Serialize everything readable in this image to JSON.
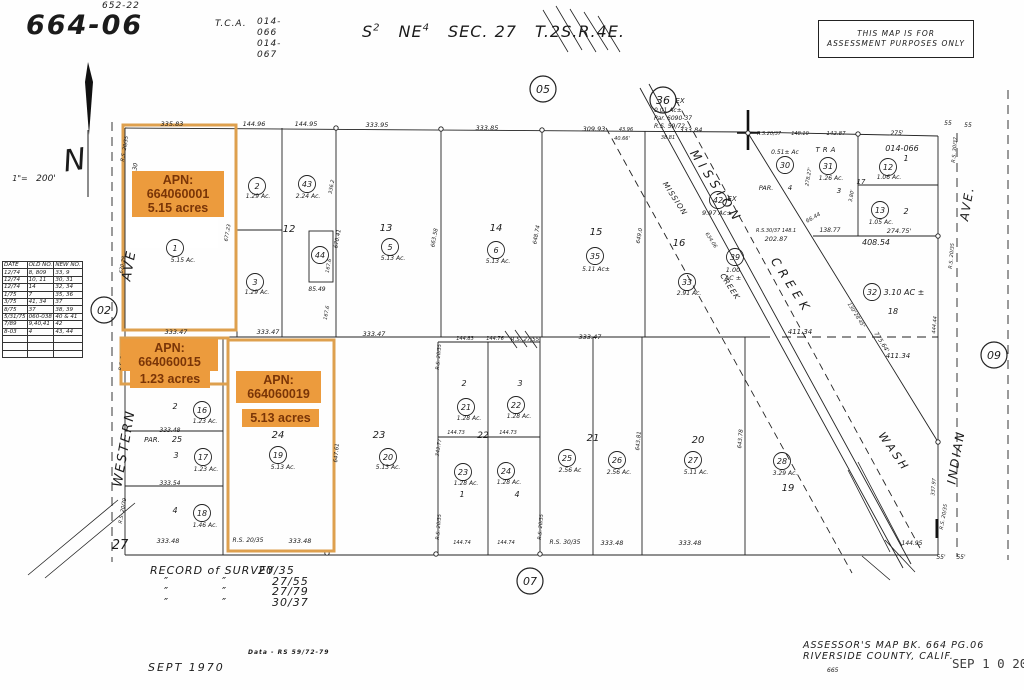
{
  "header": {
    "map_number": "664-06",
    "map_number_sup": "652-22",
    "tca_label": "T.C.A.",
    "tca_value1": "014-066",
    "tca_value2": "014-067",
    "section": {
      "s1": "S",
      "s1sup": "2",
      "s2": "NE",
      "s2sup": "4",
      "s3": "SEC. 27",
      "s4": "T.2S.R.4E."
    }
  },
  "disclaimer": {
    "line1": "THIS MAP IS FOR",
    "line2": "ASSESSMENT PURPOSES ONLY"
  },
  "legend_table": {
    "headers": [
      "DATE",
      "OLD NO.",
      "NEW NO."
    ],
    "rows": [
      [
        "12/74",
        "8, 809",
        "33, 9"
      ],
      [
        "12/74",
        "10, 11",
        "30, 31"
      ],
      [
        "12/74",
        "14",
        "32, 34"
      ],
      [
        "1/75",
        "7",
        "35, 36"
      ],
      [
        "3/75",
        "41, 34",
        "37"
      ],
      [
        "8/75",
        "37",
        "38, 39"
      ],
      [
        "5/31/75",
        "060-038",
        "40 & 41"
      ],
      [
        "7/89",
        "9,40,41",
        "42"
      ],
      [
        "8-03",
        "4",
        "43, 44"
      ]
    ],
    "empty_rows": 3
  },
  "badges": {
    "apn1": {
      "l1": "APN:",
      "l2": "664060001",
      "l3": "5.15 acres"
    },
    "apn2": {
      "l1": "APN:",
      "l2": "664060015",
      "l3": "1.23 acres"
    },
    "apn3": {
      "l1": "APN:",
      "l2": "664060019",
      "l3": "5.13 acres"
    }
  },
  "footer": {
    "survey_title": "RECORD of SURVEY",
    "survey_pages": [
      "20/35",
      "27/55",
      "27/79",
      "30/37"
    ],
    "ditto_mark": "″",
    "data_note": "Data - RS 59/72-79",
    "map_date": "SEPT 1970",
    "assessor_line1": "ASSESSOR'S MAP BK. 664  PG.06",
    "assessor_line2": "RIVERSIDE COUNTY, CALIF.",
    "plate_number": "665",
    "stamp": "SEP 1 0 2003"
  },
  "map": {
    "ref_circles": [
      {
        "n": "05",
        "x": 543,
        "y": 89
      },
      {
        "n": "02",
        "x": 104,
        "y": 310
      },
      {
        "n": "07",
        "x": 530,
        "y": 581
      },
      {
        "n": "09",
        "x": 994,
        "y": 355
      },
      {
        "n": "36",
        "x": 663,
        "y": 100
      }
    ],
    "parcel_circles": [
      {
        "n": "1",
        "x": 175,
        "y": 248
      },
      {
        "n": "2",
        "x": 257,
        "y": 186
      },
      {
        "n": "3",
        "x": 255,
        "y": 282
      },
      {
        "n": "43",
        "x": 307,
        "y": 184
      },
      {
        "n": "44",
        "x": 320,
        "y": 255
      },
      {
        "n": "5",
        "x": 390,
        "y": 247
      },
      {
        "n": "6",
        "x": 496,
        "y": 250
      },
      {
        "n": "35",
        "x": 595,
        "y": 256
      },
      {
        "n": "42",
        "x": 718,
        "y": 200
      },
      {
        "n": "33",
        "x": 687,
        "y": 282
      },
      {
        "n": "39",
        "x": 735,
        "y": 257
      },
      {
        "n": "30",
        "x": 785,
        "y": 165
      },
      {
        "n": "31",
        "x": 828,
        "y": 166
      },
      {
        "n": "12",
        "x": 888,
        "y": 167
      },
      {
        "n": "13",
        "x": 880,
        "y": 210
      },
      {
        "n": "32",
        "x": 872,
        "y": 292
      },
      {
        "n": "16",
        "x": 202,
        "y": 410
      },
      {
        "n": "17",
        "x": 203,
        "y": 457
      },
      {
        "n": "18",
        "x": 202,
        "y": 513
      },
      {
        "n": "19",
        "x": 278,
        "y": 455
      },
      {
        "n": "20",
        "x": 388,
        "y": 457
      },
      {
        "n": "21",
        "x": 466,
        "y": 407
      },
      {
        "n": "22",
        "x": 516,
        "y": 405
      },
      {
        "n": "23",
        "x": 463,
        "y": 472
      },
      {
        "n": "24",
        "x": 506,
        "y": 471
      },
      {
        "n": "25",
        "x": 567,
        "y": 458
      },
      {
        "n": "26",
        "x": 617,
        "y": 460
      },
      {
        "n": "27",
        "x": 693,
        "y": 460
      },
      {
        "n": "28",
        "x": 782,
        "y": 461
      }
    ],
    "texts": [
      {
        "t": "N",
        "x": 76,
        "y": 170,
        "s": 30,
        "r": -8
      },
      {
        "t": "1\"=",
        "x": 20,
        "y": 181,
        "s": 8
      },
      {
        "t": "200'",
        "x": 46,
        "y": 181,
        "s": 9
      },
      {
        "t": "335.83",
        "x": 172,
        "y": 126
      },
      {
        "t": "144.96",
        "x": 254,
        "y": 126
      },
      {
        "t": "144.95",
        "x": 306,
        "y": 126
      },
      {
        "t": "333.95",
        "x": 377,
        "y": 127
      },
      {
        "t": "333.85",
        "x": 487,
        "y": 130
      },
      {
        "t": "309.93",
        "x": 594,
        "y": 131
      },
      {
        "t": "43.96",
        "x": 626,
        "y": 131,
        "s": 5
      },
      {
        "t": "40.66'",
        "x": 622,
        "y": 140,
        "s": 5
      },
      {
        "t": "38.81",
        "x": 668,
        "y": 139,
        "s": 5
      },
      {
        "t": "333.84",
        "x": 691,
        "y": 132
      },
      {
        "t": "R.S.20/37",
        "x": 769,
        "y": 135,
        "s": 5
      },
      {
        "t": "148.10",
        "x": 800,
        "y": 135,
        "s": 5
      },
      {
        "t": "142.87",
        "x": 836,
        "y": 135,
        "s": 5.5
      },
      {
        "t": "275'",
        "x": 897,
        "y": 135,
        "s": 6
      },
      {
        "t": "55",
        "x": 948,
        "y": 125,
        "s": 6
      },
      {
        "t": "55",
        "x": 968,
        "y": 127,
        "s": 6
      },
      {
        "t": "EX",
        "x": 680,
        "y": 103,
        "s": 7
      },
      {
        "t": "0.01 Ac±",
        "x": 654,
        "y": 112,
        "s": 6,
        "a": "s"
      },
      {
        "t": "Par. 6090-37",
        "x": 654,
        "y": 120,
        "s": 6,
        "a": "s"
      },
      {
        "t": "R.S. 59/72",
        "x": 654,
        "y": 128,
        "s": 6,
        "a": "s"
      },
      {
        "t": "TRA",
        "x": 827,
        "y": 152,
        "s": 7,
        "ls": 3
      },
      {
        "t": "014-066",
        "x": 902,
        "y": 151,
        "s": 8
      },
      {
        "t": "1",
        "x": 906,
        "y": 161,
        "s": 8
      },
      {
        "t": "1.06 Ac.",
        "x": 889,
        "y": 179,
        "s": 6
      },
      {
        "t": "2",
        "x": 906,
        "y": 214,
        "s": 8
      },
      {
        "t": "1.05 Ac.",
        "x": 881,
        "y": 224,
        "s": 6
      },
      {
        "t": "17",
        "x": 861,
        "y": 184,
        "s": 7
      },
      {
        "t": "274.75'",
        "x": 899,
        "y": 233,
        "s": 6.5
      },
      {
        "t": "408.54",
        "x": 876,
        "y": 245,
        "s": 8
      },
      {
        "t": "0.51± Ac",
        "x": 785,
        "y": 154,
        "s": 6
      },
      {
        "t": "PAR.",
        "x": 766,
        "y": 190,
        "s": 6.5
      },
      {
        "t": "4",
        "x": 790,
        "y": 190,
        "s": 7
      },
      {
        "t": "1.26 Ac.",
        "x": 831,
        "y": 180,
        "s": 6
      },
      {
        "t": "3",
        "x": 839,
        "y": 193,
        "s": 7
      },
      {
        "t": "278.27'",
        "x": 810,
        "y": 177,
        "s": 5,
        "r": -80
      },
      {
        "t": "3.80'",
        "x": 853,
        "y": 196,
        "s": 5,
        "r": -80
      },
      {
        "t": "R.S.30/37 148.1",
        "x": 756,
        "y": 232,
        "s": 5,
        "a": "s"
      },
      {
        "t": "202.87",
        "x": 776,
        "y": 241,
        "s": 6.5
      },
      {
        "t": "66.44",
        "x": 814,
        "y": 219,
        "s": 5.5,
        "r": -30
      },
      {
        "t": "138.77",
        "x": 830,
        "y": 232,
        "s": 6
      },
      {
        "t": "R.S. 30/37",
        "x": 956,
        "y": 150,
        "s": 5,
        "r": -85
      },
      {
        "t": "411.34",
        "x": 800,
        "y": 334,
        "s": 7
      },
      {
        "t": "411.34",
        "x": 898,
        "y": 358,
        "s": 7
      },
      {
        "t": "3.10 AC ±",
        "x": 904,
        "y": 295,
        "s": 8
      },
      {
        "t": "18",
        "x": 893,
        "y": 314,
        "s": 8
      },
      {
        "t": "130°28'45\"",
        "x": 855,
        "y": 316,
        "s": 5,
        "r": 58
      },
      {
        "t": "775.64'",
        "x": 880,
        "y": 343,
        "s": 6,
        "r": 58
      },
      {
        "t": "444.44",
        "x": 936,
        "y": 325,
        "s": 5,
        "r": -85
      },
      {
        "t": "R.S. 20/35",
        "x": 953,
        "y": 256,
        "s": 5,
        "r": -85
      },
      {
        "t": "337.97",
        "x": 935,
        "y": 487,
        "s": 5,
        "r": -85
      },
      {
        "t": "R.S. 20/35",
        "x": 945,
        "y": 517,
        "s": 5,
        "r": -80
      },
      {
        "t": "144.95",
        "x": 912,
        "y": 545,
        "s": 6
      },
      {
        "t": "55'",
        "x": 941,
        "y": 559,
        "s": 6
      },
      {
        "t": "55'",
        "x": 961,
        "y": 559,
        "s": 6
      },
      {
        "t": "AVE",
        "x": 133,
        "y": 266,
        "s": 13,
        "r": -80,
        "ls": 2
      },
      {
        "t": "WESTERN",
        "x": 128,
        "y": 449,
        "s": 13,
        "r": -80,
        "ls": 2
      },
      {
        "t": "MISSION",
        "x": 713,
        "y": 189,
        "s": 12,
        "r": 57,
        "ls": 5
      },
      {
        "t": "CREEK",
        "x": 788,
        "y": 288,
        "s": 12,
        "r": 57,
        "ls": 5
      },
      {
        "t": "MISSION",
        "x": 673,
        "y": 200,
        "s": 7.5,
        "r": 57,
        "ls": 1
      },
      {
        "t": "CREEK",
        "x": 728,
        "y": 288,
        "s": 7.5,
        "r": 57,
        "ls": 1
      },
      {
        "t": "634.06",
        "x": 710,
        "y": 241,
        "s": 5,
        "r": 57
      },
      {
        "t": "WASH",
        "x": 891,
        "y": 454,
        "s": 11,
        "r": 55,
        "ls": 3
      },
      {
        "t": "INDIAN",
        "x": 960,
        "y": 458,
        "s": 12,
        "r": -80,
        "ls": 2
      },
      {
        "t": "AVE.",
        "x": 971,
        "y": 204,
        "s": 12,
        "r": -80,
        "ls": 2
      },
      {
        "t": "12",
        "x": 289,
        "y": 232,
        "s": 10
      },
      {
        "t": "13",
        "x": 386,
        "y": 231,
        "s": 10
      },
      {
        "t": "14",
        "x": 496,
        "y": 231,
        "s": 10
      },
      {
        "t": "15",
        "x": 596,
        "y": 235,
        "s": 10
      },
      {
        "t": "16",
        "x": 679,
        "y": 246,
        "s": 10
      },
      {
        "t": "5.15 Ac.",
        "x": 183,
        "y": 262,
        "s": 6
      },
      {
        "t": "1.29 Ac.",
        "x": 258,
        "y": 198,
        "s": 6
      },
      {
        "t": "1.29 Ac.",
        "x": 257,
        "y": 294,
        "s": 6
      },
      {
        "t": "2.24 Ac.",
        "x": 308,
        "y": 198,
        "s": 6
      },
      {
        "t": "5.13 Ac.",
        "x": 393,
        "y": 260,
        "s": 6
      },
      {
        "t": "5.13 Ac.",
        "x": 498,
        "y": 263,
        "s": 6
      },
      {
        "t": "5.11 Ac±",
        "x": 596,
        "y": 271,
        "s": 6
      },
      {
        "t": "2.91 Ac.",
        "x": 689,
        "y": 295,
        "s": 6
      },
      {
        "t": "9.97 Ac±",
        "x": 717,
        "y": 215,
        "s": 6.5
      },
      {
        "t": "EX",
        "x": 732,
        "y": 201,
        "s": 7
      },
      {
        "t": "1.00",
        "x": 733,
        "y": 272,
        "s": 6.5
      },
      {
        "t": "AC ±",
        "x": 733,
        "y": 280,
        "s": 6.5
      },
      {
        "t": "85.49",
        "x": 317,
        "y": 291,
        "s": 6
      },
      {
        "t": "167.6",
        "x": 330,
        "y": 266,
        "s": 5,
        "r": -80
      },
      {
        "t": "167.6",
        "x": 328,
        "y": 313,
        "s": 5,
        "r": -80
      },
      {
        "t": "336.2",
        "x": 333,
        "y": 187,
        "s": 5,
        "r": -80
      },
      {
        "t": "670.41",
        "x": 339,
        "y": 239,
        "s": 5.5,
        "r": -80
      },
      {
        "t": "663.58",
        "x": 436,
        "y": 238,
        "s": 5.5,
        "r": -80
      },
      {
        "t": "648.74",
        "x": 538,
        "y": 235,
        "s": 5.5,
        "r": -80
      },
      {
        "t": "649.0",
        "x": 641,
        "y": 236,
        "s": 5.5,
        "r": -80
      },
      {
        "t": "677.23",
        "x": 229,
        "y": 233,
        "s": 5,
        "r": -80
      },
      {
        "t": "670.28",
        "x": 124,
        "y": 265,
        "s": 5,
        "r": -80
      },
      {
        "t": "R.S. 20/35",
        "x": 126,
        "y": 149,
        "s": 5,
        "r": -80
      },
      {
        "t": "30",
        "x": 137,
        "y": 167,
        "s": 6,
        "r": -80
      },
      {
        "t": "R.S. 20/35",
        "x": 124,
        "y": 358,
        "s": 5,
        "r": -80
      },
      {
        "t": "R.S. 20/79",
        "x": 124,
        "y": 511,
        "s": 5,
        "r": -80
      },
      {
        "t": "333.47",
        "x": 176,
        "y": 334
      },
      {
        "t": "333.47",
        "x": 268,
        "y": 334
      },
      {
        "t": "333.47",
        "x": 374,
        "y": 336
      },
      {
        "t": "144.83",
        "x": 465,
        "y": 340,
        "s": 5
      },
      {
        "t": "144.76",
        "x": 495,
        "y": 340,
        "s": 5
      },
      {
        "t": "R.S. 27/55",
        "x": 525,
        "y": 341,
        "s": 5.5
      },
      {
        "t": "333.47",
        "x": 590,
        "y": 339
      },
      {
        "t": "2",
        "x": 175,
        "y": 409,
        "s": 8
      },
      {
        "t": "1.23 Ac.",
        "x": 205,
        "y": 423,
        "s": 6
      },
      {
        "t": "PAR.",
        "x": 152,
        "y": 442,
        "s": 7
      },
      {
        "t": "25",
        "x": 177,
        "y": 442,
        "s": 8
      },
      {
        "t": "333.48",
        "x": 170,
        "y": 432,
        "s": 6
      },
      {
        "t": "3",
        "x": 176,
        "y": 458,
        "s": 8
      },
      {
        "t": "1.23 Ac.",
        "x": 206,
        "y": 471,
        "s": 6
      },
      {
        "t": "333.54",
        "x": 170,
        "y": 485,
        "s": 6
      },
      {
        "t": "4",
        "x": 175,
        "y": 513,
        "s": 8
      },
      {
        "t": "1.46 Ac.",
        "x": 205,
        "y": 527,
        "s": 6
      },
      {
        "t": "24",
        "x": 278,
        "y": 438,
        "s": 10
      },
      {
        "t": "5.13 Ac.",
        "x": 283,
        "y": 469,
        "s": 6
      },
      {
        "t": "23",
        "x": 379,
        "y": 438,
        "s": 10
      },
      {
        "t": "5.13 Ac.",
        "x": 388,
        "y": 469,
        "s": 6
      },
      {
        "t": "2",
        "x": 464,
        "y": 386,
        "s": 8
      },
      {
        "t": "3",
        "x": 520,
        "y": 386,
        "s": 8
      },
      {
        "t": "1.28 Ac.",
        "x": 469,
        "y": 420,
        "s": 6
      },
      {
        "t": "1.28 Ac.",
        "x": 519,
        "y": 418,
        "s": 6
      },
      {
        "t": "22",
        "x": 483,
        "y": 438,
        "s": 9
      },
      {
        "t": "144.73",
        "x": 456,
        "y": 434,
        "s": 5
      },
      {
        "t": "144.73",
        "x": 508,
        "y": 434,
        "s": 5
      },
      {
        "t": "1",
        "x": 462,
        "y": 497,
        "s": 8
      },
      {
        "t": "4",
        "x": 517,
        "y": 497,
        "s": 8
      },
      {
        "t": "1.28 Ac.",
        "x": 466,
        "y": 485,
        "s": 6
      },
      {
        "t": "1.28 Ac.",
        "x": 509,
        "y": 484,
        "s": 6
      },
      {
        "t": "21",
        "x": 593,
        "y": 441,
        "s": 10
      },
      {
        "t": "2.56 Ac",
        "x": 570,
        "y": 472,
        "s": 6
      },
      {
        "t": "2.56 Ac.",
        "x": 619,
        "y": 474,
        "s": 6
      },
      {
        "t": "20",
        "x": 698,
        "y": 443,
        "s": 10
      },
      {
        "t": "5.11 Ac.",
        "x": 696,
        "y": 474,
        "s": 6
      },
      {
        "t": "19",
        "x": 788,
        "y": 491,
        "s": 10
      },
      {
        "t": "3.29 Ac.",
        "x": 785,
        "y": 475,
        "s": 6
      },
      {
        "t": "343.77",
        "x": 440,
        "y": 448,
        "s": 5,
        "r": -80
      },
      {
        "t": "643.81",
        "x": 640,
        "y": 441,
        "s": 5.5,
        "r": -85
      },
      {
        "t": "643.78",
        "x": 742,
        "y": 439,
        "s": 5.5,
        "r": -85
      },
      {
        "t": "647.61",
        "x": 338,
        "y": 453,
        "s": 5.5,
        "r": -85
      },
      {
        "t": "R.S. 20/35",
        "x": 440,
        "y": 357,
        "s": 5,
        "r": -85
      },
      {
        "t": "R.S. 20/35",
        "x": 440,
        "y": 527,
        "s": 5,
        "r": -85
      },
      {
        "t": "R.S. 20/35",
        "x": 542,
        "y": 527,
        "s": 5,
        "r": -85
      },
      {
        "t": "333.48",
        "x": 168,
        "y": 543,
        "s": 6.5
      },
      {
        "t": "R.S. 20/35",
        "x": 248,
        "y": 542,
        "s": 6
      },
      {
        "t": "333.48",
        "x": 300,
        "y": 543,
        "s": 6.5
      },
      {
        "t": "144.74",
        "x": 462,
        "y": 544,
        "s": 5
      },
      {
        "t": "144.74",
        "x": 506,
        "y": 544,
        "s": 5
      },
      {
        "t": "R.S. 30/35",
        "x": 565,
        "y": 544,
        "s": 6
      },
      {
        "t": "333.48",
        "x": 612,
        "y": 545,
        "s": 6.5
      },
      {
        "t": "333.48",
        "x": 690,
        "y": 545,
        "s": 6.5
      },
      {
        "t": "27",
        "x": 120,
        "y": 549,
        "s": 13
      }
    ]
  }
}
